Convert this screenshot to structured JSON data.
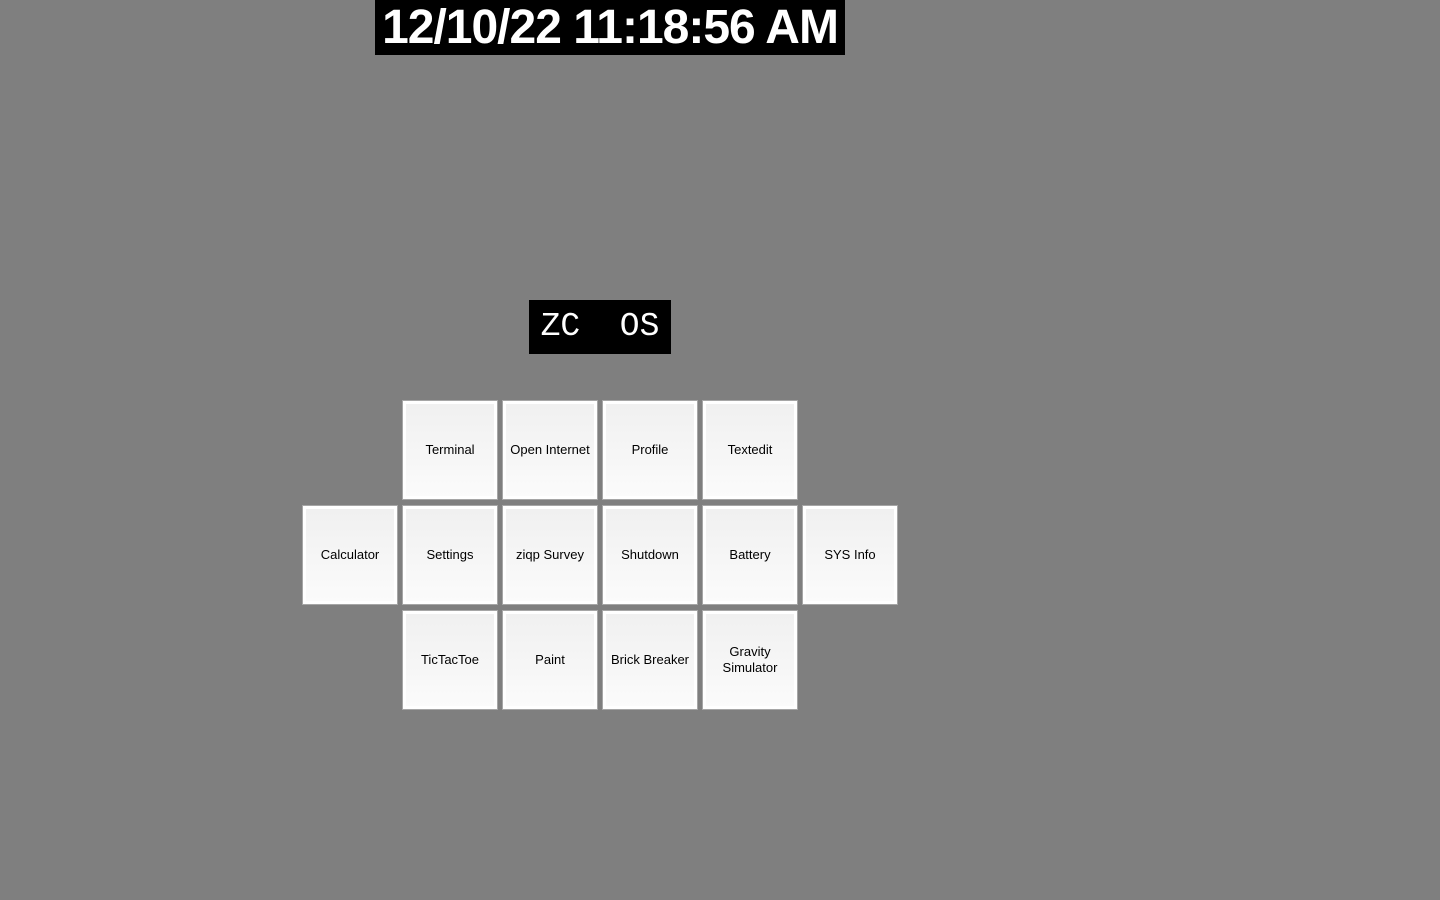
{
  "clock": {
    "text": "12/10/22 11:18:56 AM"
  },
  "logo": {
    "text": "ZC  OS"
  },
  "colors": {
    "background": "#7f7f7f",
    "panel_background": "#000000",
    "panel_text": "#ffffff",
    "tile_face_top": "#f0f0f0",
    "tile_face_bottom": "#fbfbfb",
    "tile_border": "#ffffff",
    "tile_outline": "#a6a6a6",
    "tile_text": "#000000"
  },
  "app_grid": {
    "rows": [
      [
        "Terminal",
        "Open Internet",
        "Profile",
        "Textedit"
      ],
      [
        "Calculator",
        "Settings",
        "ziqp Survey",
        "Shutdown",
        "Battery",
        "SYS Info"
      ],
      [
        "TicTacToe",
        "Paint",
        "Brick Breaker",
        "Gravity Simulator"
      ]
    ]
  }
}
